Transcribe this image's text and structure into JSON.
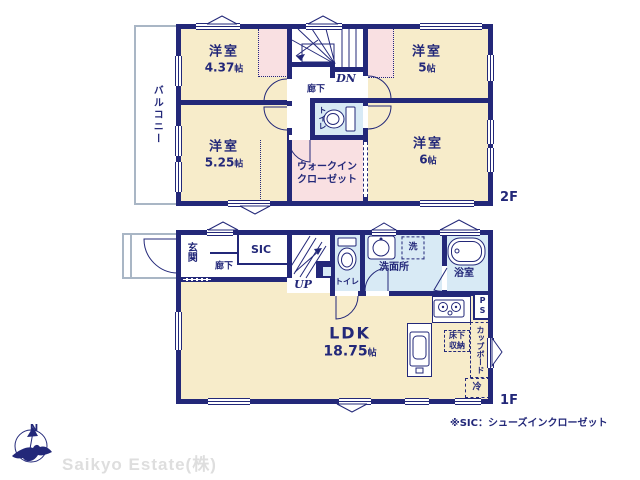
{
  "floor2": {
    "label": "2F",
    "balcony": "バルコニー",
    "hallway": "廊下",
    "dn": "DN",
    "toilet": "トイレ",
    "wic": "ウォークインクローゼット",
    "rooms": {
      "nw": {
        "name": "洋室",
        "size_value": "4.37",
        "size_unit": "帖"
      },
      "ne": {
        "name": "洋室",
        "size_value": "5",
        "size_unit": "帖"
      },
      "sw": {
        "name": "洋室",
        "size_value": "5.25",
        "size_unit": "帖"
      },
      "se": {
        "name": "洋室",
        "size_value": "6",
        "size_unit": "帖"
      }
    }
  },
  "floor1": {
    "label": "1F",
    "entrance": "玄関",
    "hallway": "廊下",
    "sic": "SIC",
    "up": "UP",
    "toilet": "トイレ",
    "washroom": "洗面所",
    "washer": "洗",
    "bathroom": "浴室",
    "ldk": {
      "name": "LDK",
      "size_value": "18.75",
      "size_unit": "帖"
    },
    "floor_storage": "床下収納",
    "cupboard": "カップボード",
    "refrigerator": "冷",
    "pipe_space": "PS"
  },
  "footer": {
    "compass_north": "N",
    "company": "Saikyo Estate(株)",
    "note": "※SIC：シューズインクローゼット"
  },
  "colors": {
    "wall": "#232879",
    "room": "#f7ecca",
    "closet": "#f9e0e2",
    "wet": "#d8eaf5",
    "outline": "#a9b6c5",
    "logo": "#dedede"
  }
}
